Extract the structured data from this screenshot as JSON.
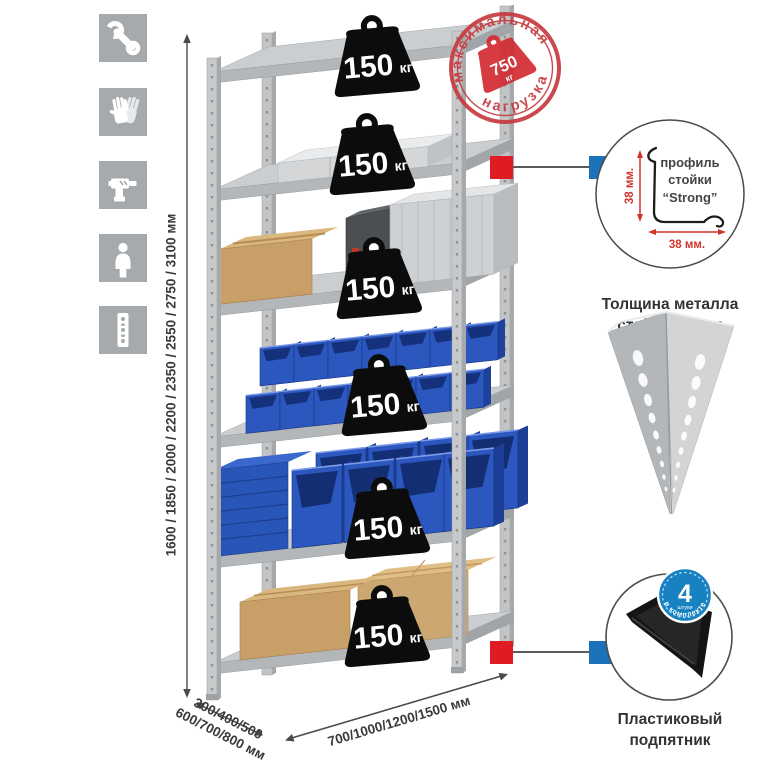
{
  "left_toolbar": {
    "icons": [
      {
        "name": "wrench"
      },
      {
        "name": "gloves"
      },
      {
        "name": "drill"
      },
      {
        "name": "person"
      },
      {
        "name": "rack-post"
      }
    ]
  },
  "height_dimension": {
    "label": "1600 / 1850 / 2000 / 2200 / 2350 / 2550 / 2750 / 3100 мм"
  },
  "depth_dimension": {
    "line1": "300/400/500",
    "line2": "600/700/800 мм"
  },
  "width_dimension": {
    "label": "700/1000/1200/1500 мм"
  },
  "shelf_load_badge": {
    "value": "150",
    "unit": "кг"
  },
  "max_load_stamp": {
    "arc_top": "максимальная",
    "arc_bottom": "нагрузка",
    "value": "750",
    "unit": "кг"
  },
  "post_profile_detail": {
    "label_line1": "профиль",
    "label_line2": "стойки",
    "label_line3": "“Strong”",
    "vertical_dim": "38 мм.",
    "horizontal_dim": "38 мм.",
    "caption_line1": "Толщина металла",
    "caption_line2": "стойки 1,2 мм"
  },
  "foot_detail": {
    "badge_number": "4",
    "badge_unit": "штуки",
    "badge_arc": "в комплекте",
    "caption_line1": "Пластиковый",
    "caption_line2": "подпятник"
  },
  "colors": {
    "stamp_red": "#c63c41",
    "marker_red": "#e01b24",
    "marker_blue": "#1b72b8",
    "badge_blue": "#1781c2",
    "bin_blue": "#2b57bf",
    "cardboard": "#c89f67",
    "metal_gray": "#c7c9cb",
    "icon_gray": "#a7aaac"
  }
}
